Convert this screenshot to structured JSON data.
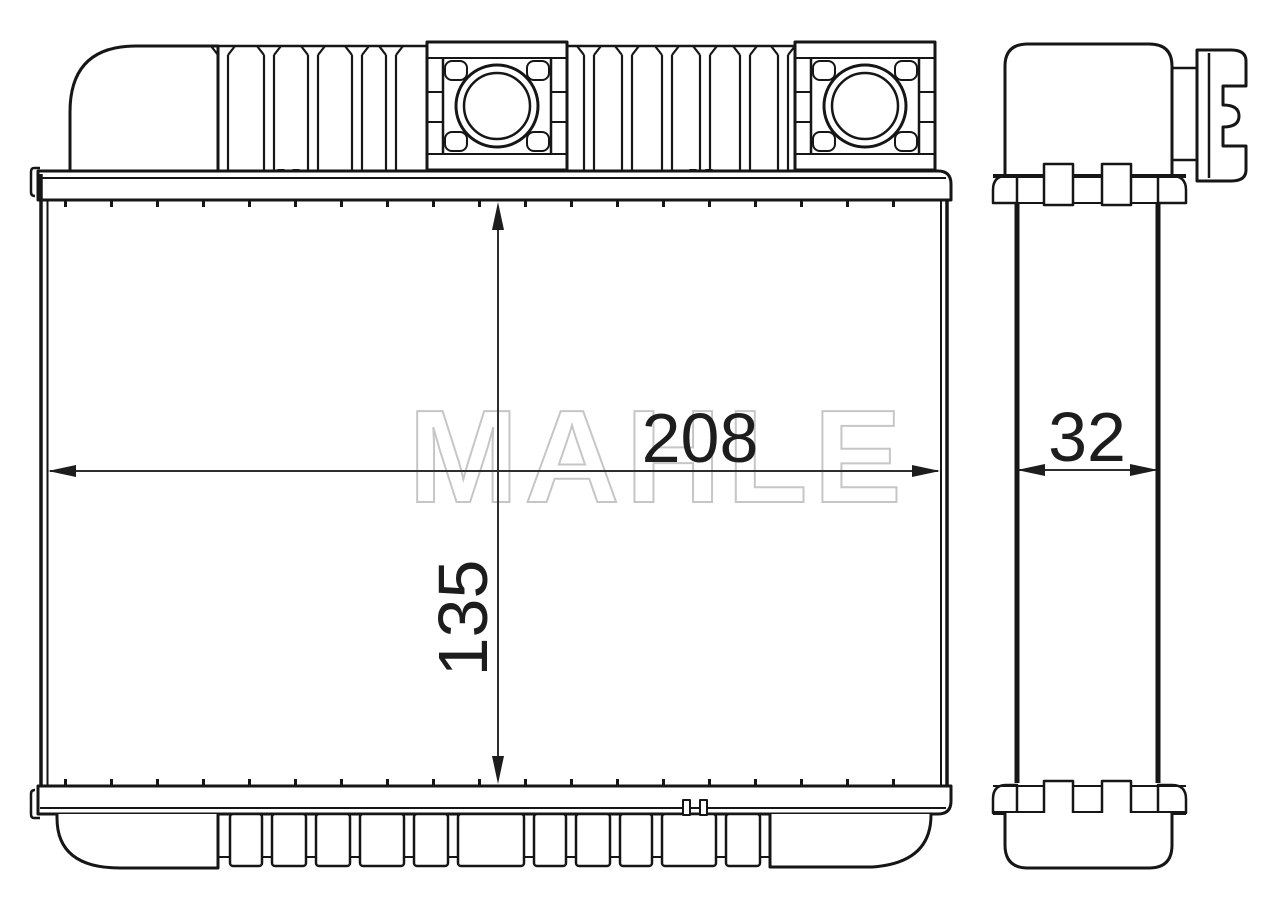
{
  "drawing": {
    "watermark": "MAHLE",
    "dimensions": {
      "core_width": "208",
      "core_height": "135",
      "core_depth": "32"
    },
    "colors": {
      "line": "#161616",
      "dimension_line": "#2e2e2e",
      "watermark_outline": "#c6c6c6",
      "background": "#ffffff"
    }
  }
}
